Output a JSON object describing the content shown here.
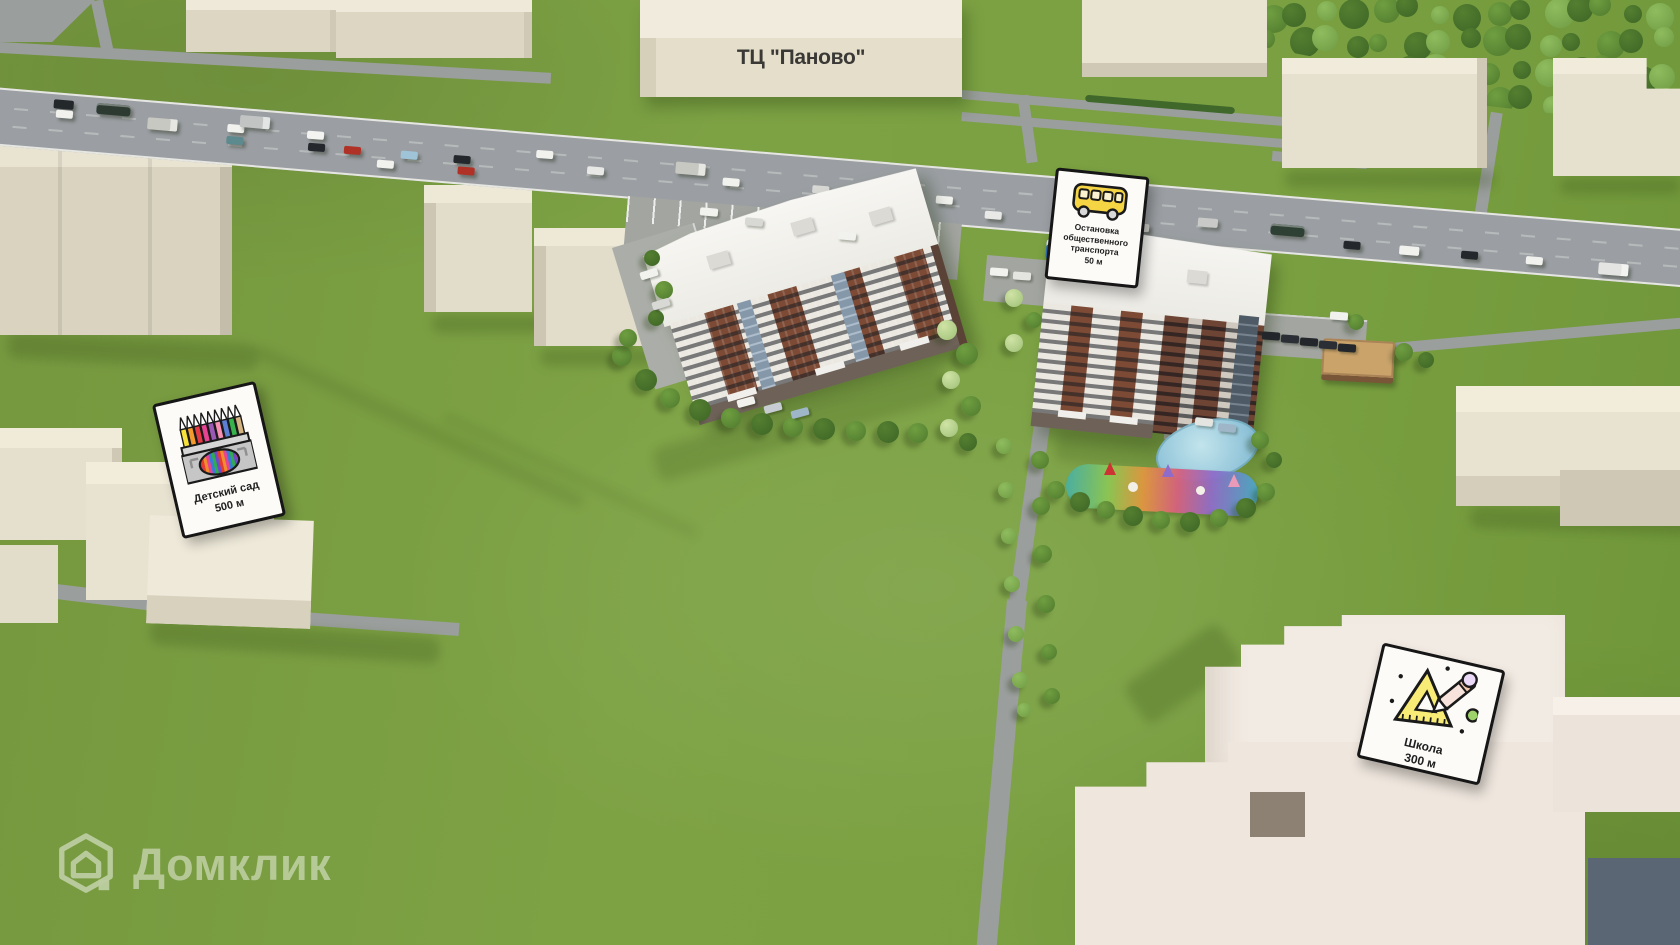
{
  "page": {
    "description": "3D aerial site-plan render of a residential complex with amenity distance signs"
  },
  "labels": {
    "mall": "ТЦ \"Паново\"",
    "bus_stop": {
      "lines": [
        "Остановка",
        "общественного",
        "транспорта"
      ],
      "distance": "50 м"
    },
    "kindergarten": {
      "name": "Детский сад",
      "distance": "500 м"
    },
    "school": {
      "name": "Школа",
      "distance": "300 м"
    },
    "watermark": "Домклик"
  },
  "colors": {
    "grass": "#7aa041",
    "road": "#9b9fa3",
    "path": "#9a9e9c",
    "building_top": "#eee9d9",
    "building_front": "#ddd6c3",
    "brick": "#7d4b35",
    "card_bg": "#fcfbf8",
    "card_border": "#161616",
    "bus_yellow": "#f6d544",
    "pond": "#8fc3d8",
    "accent_green": "#9ed36a",
    "accent_lavender": "#ead9f7"
  },
  "scene": {
    "vehicles": [
      {
        "x": 75,
        "lane": 0,
        "color": "#23282b",
        "type": "van"
      },
      {
        "x": 118,
        "lane": 0,
        "color": "#2c3a31",
        "type": "bus"
      },
      {
        "x": 78,
        "lane": 1,
        "color": "#f1f1ee",
        "type": "car"
      },
      {
        "x": 170,
        "lane": 1,
        "color": "#c8c8c2",
        "type": "truck"
      },
      {
        "x": 250,
        "lane": 1,
        "color": "#f1f1ee",
        "type": "car"
      },
      {
        "x": 262,
        "lane": 0,
        "color": "#c2c4c4",
        "type": "truck"
      },
      {
        "x": 330,
        "lane": 1,
        "color": "#f3f3f1",
        "type": "car"
      },
      {
        "x": 250,
        "lane": 2,
        "color": "#5d8a8f",
        "type": "car"
      },
      {
        "x": 368,
        "lane": 2,
        "color": "#b03226",
        "type": "car"
      },
      {
        "x": 332,
        "lane": 2,
        "color": "#24272c",
        "type": "car"
      },
      {
        "x": 425,
        "lane": 2,
        "color": "#9fc4d8",
        "type": "car"
      },
      {
        "x": 478,
        "lane": 2,
        "color": "#24272c",
        "type": "car"
      },
      {
        "x": 402,
        "lane": 3,
        "color": "#f1f1ee",
        "type": "car"
      },
      {
        "x": 483,
        "lane": 3,
        "color": "#b03226",
        "type": "car"
      },
      {
        "x": 560,
        "lane": 1,
        "color": "#f1f1ee",
        "type": "car"
      },
      {
        "x": 612,
        "lane": 2,
        "color": "#e8e8e6",
        "type": "car"
      },
      {
        "x": 700,
        "lane": 1,
        "color": "#c8c8c2",
        "type": "truck"
      },
      {
        "x": 748,
        "lane": 2,
        "color": "#f1f1ee",
        "type": "car"
      },
      {
        "x": 838,
        "lane": 2,
        "color": "#d9d9d6",
        "type": "car"
      },
      {
        "x": 905,
        "lane": 1,
        "color": "#24272c",
        "type": "car"
      },
      {
        "x": 962,
        "lane": 2,
        "color": "#f1f1ee",
        "type": "car"
      },
      {
        "x": 1012,
        "lane": 3,
        "color": "#e8e8e6",
        "type": "car"
      },
      {
        "x": 1085,
        "lane": 2,
        "color": "#f1f1ee",
        "type": "van"
      },
      {
        "x": 1160,
        "lane": 3,
        "color": "#d0d0cc",
        "type": "car"
      },
      {
        "x": 1225,
        "lane": 2,
        "color": "#c9cac8",
        "type": "van"
      },
      {
        "x": 1298,
        "lane": 2,
        "color": "#2e4034",
        "type": "bus"
      },
      {
        "x": 1372,
        "lane": 3,
        "color": "#24272c",
        "type": "car"
      },
      {
        "x": 1428,
        "lane": 3,
        "color": "#f1f1ee",
        "type": "van"
      },
      {
        "x": 1490,
        "lane": 3,
        "color": "#24272c",
        "type": "car"
      },
      {
        "x": 1555,
        "lane": 3,
        "color": "#f1f1ee",
        "type": "car"
      },
      {
        "x": 1628,
        "lane": 3,
        "color": "#e4e4e2",
        "type": "truck"
      }
    ],
    "trees": [
      [
        622,
        356,
        10,
        "m"
      ],
      [
        646,
        380,
        11,
        "d"
      ],
      [
        670,
        398,
        10,
        "m"
      ],
      [
        700,
        410,
        11,
        "d"
      ],
      [
        731,
        418,
        10,
        "m"
      ],
      [
        762,
        424,
        11,
        "d"
      ],
      [
        793,
        427,
        10,
        "m"
      ],
      [
        824,
        429,
        11,
        "d"
      ],
      [
        856,
        431,
        10,
        "m"
      ],
      [
        888,
        432,
        11,
        "d"
      ],
      [
        918,
        433,
        10,
        "m"
      ],
      [
        652,
        258,
        8,
        "d"
      ],
      [
        664,
        290,
        9,
        "m"
      ],
      [
        656,
        318,
        8,
        "d"
      ],
      [
        628,
        338,
        9,
        "m"
      ],
      [
        947,
        330,
        10,
        "b"
      ],
      [
        967,
        354,
        11,
        "m"
      ],
      [
        951,
        380,
        9,
        "b"
      ],
      [
        971,
        406,
        10,
        "m"
      ],
      [
        949,
        428,
        9,
        "b"
      ],
      [
        968,
        442,
        9,
        "d"
      ],
      [
        1014,
        298,
        9,
        "b"
      ],
      [
        1034,
        320,
        8,
        "m"
      ],
      [
        1014,
        343,
        9,
        "b"
      ],
      [
        1056,
        490,
        9,
        "m"
      ],
      [
        1080,
        502,
        10,
        "d"
      ],
      [
        1106,
        510,
        9,
        "m"
      ],
      [
        1133,
        516,
        10,
        "d"
      ],
      [
        1161,
        520,
        9,
        "m"
      ],
      [
        1190,
        522,
        10,
        "d"
      ],
      [
        1219,
        518,
        9,
        "m"
      ],
      [
        1246,
        508,
        10,
        "d"
      ],
      [
        1266,
        492,
        9,
        "m"
      ],
      [
        1260,
        440,
        9,
        "m"
      ],
      [
        1274,
        460,
        8,
        "d"
      ],
      [
        1004,
        446,
        8,
        "l"
      ],
      [
        1040,
        460,
        9,
        "m"
      ],
      [
        1006,
        490,
        8,
        "l"
      ],
      [
        1041,
        506,
        9,
        "m"
      ],
      [
        1009,
        536,
        8,
        "l"
      ],
      [
        1043,
        554,
        9,
        "m"
      ],
      [
        1012,
        584,
        8,
        "l"
      ],
      [
        1046,
        604,
        9,
        "m"
      ],
      [
        1016,
        634,
        8,
        "l"
      ],
      [
        1049,
        652,
        8,
        "m"
      ],
      [
        1020,
        680,
        8,
        "l"
      ],
      [
        1052,
        696,
        8,
        "m"
      ],
      [
        1024,
        710,
        7,
        "l"
      ],
      [
        1404,
        352,
        9,
        "m"
      ],
      [
        1426,
        360,
        8,
        "d"
      ],
      [
        1356,
        322,
        8,
        "m"
      ]
    ],
    "parked": [
      {
        "x": 700,
        "y": 208,
        "r": 5,
        "c": "#f1f1ee"
      },
      {
        "x": 745,
        "y": 218,
        "r": 5,
        "c": "#d8d8d4"
      },
      {
        "x": 838,
        "y": 232,
        "r": 5,
        "c": "#f1f1ee"
      },
      {
        "x": 640,
        "y": 270,
        "r": -17,
        "c": "#f1f1ee"
      },
      {
        "x": 652,
        "y": 300,
        "r": -17,
        "c": "#d8d8d4"
      },
      {
        "x": 737,
        "y": 398,
        "r": -15,
        "c": "#f1f1ee"
      },
      {
        "x": 764,
        "y": 404,
        "r": -15,
        "c": "#c7ccd2"
      },
      {
        "x": 791,
        "y": 409,
        "r": -15,
        "c": "#9fb6c9"
      },
      {
        "x": 990,
        "y": 268,
        "r": 4,
        "c": "#f1f1ee"
      },
      {
        "x": 1013,
        "y": 272,
        "r": 4,
        "c": "#e4e4e0"
      },
      {
        "x": 1262,
        "y": 332,
        "r": 4,
        "c": "#23262b"
      },
      {
        "x": 1281,
        "y": 335,
        "r": 4,
        "c": "#2b2f35"
      },
      {
        "x": 1300,
        "y": 338,
        "r": 4,
        "c": "#23262b"
      },
      {
        "x": 1319,
        "y": 341,
        "r": 4,
        "c": "#2b2f35"
      },
      {
        "x": 1338,
        "y": 344,
        "r": 4,
        "c": "#23262b"
      },
      {
        "x": 1330,
        "y": 312,
        "r": 4,
        "c": "#f1f1ee"
      },
      {
        "x": 1195,
        "y": 418,
        "r": 6,
        "c": "#e4e4e0"
      },
      {
        "x": 1218,
        "y": 424,
        "r": 6,
        "c": "#9fb6c9"
      }
    ]
  }
}
